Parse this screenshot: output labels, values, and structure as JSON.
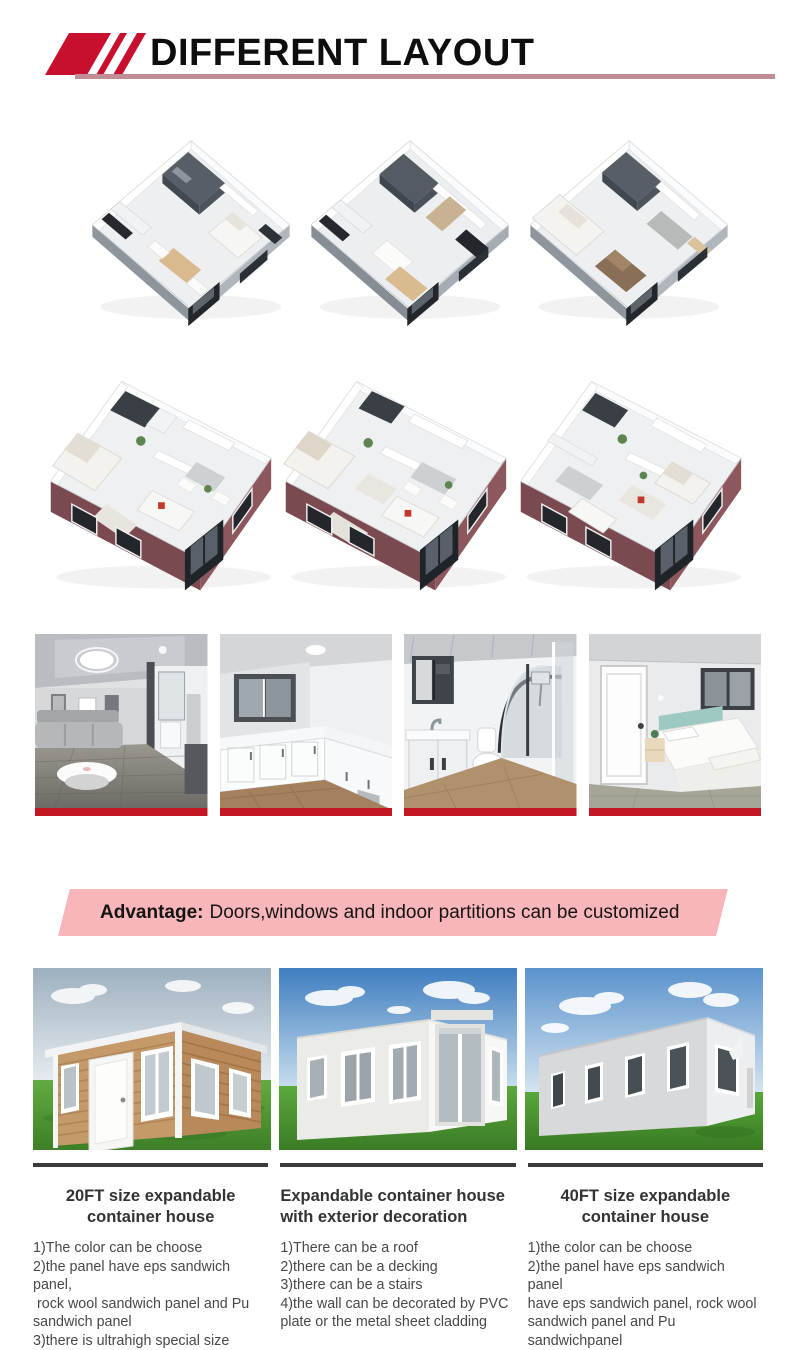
{
  "header": {
    "title": "DIFFERENT LAYOUT"
  },
  "advantage": {
    "label": "Advantage:",
    "text": "Doors,windows and indoor partitions can be customized"
  },
  "colors": {
    "brand_red": "#c8102e",
    "underline_rose": "#c28e95",
    "banner_pink": "#f9b6ba",
    "photo_bar_red": "#c21722",
    "maroon_wall": "#7b4a51"
  },
  "gallery": {
    "floor_plans_row1": [
      "one-bedroom-layout",
      "two-room-layout",
      "two-bedroom-layout"
    ],
    "floor_plans_row2": [
      "large-layout-a",
      "large-layout-b",
      "large-layout-c"
    ],
    "interiors": [
      "living-room-photo",
      "kitchen-photo",
      "bathroom-photo",
      "bedroom-photo"
    ],
    "houses": [
      "wooden-expandable-house",
      "white-expandable-house",
      "long-expandable-house"
    ]
  },
  "products": [
    {
      "title_lines": [
        "20FT size expandable",
        "container house"
      ],
      "features": [
        "1)The color can be choose",
        "2)the panel have eps sandwich panel,",
        " rock wool sandwich panel and Pu",
        "sandwich panel",
        "3)there is ultrahigh special size"
      ]
    },
    {
      "title_lines": [
        "Expandable container house",
        "with exterior decoration"
      ],
      "features": [
        "1)There can be a roof",
        "2)there can be a decking",
        "3)there can be a stairs",
        "4)the wall can be decorated by PVC",
        "plate or the metal sheet cladding"
      ]
    },
    {
      "title_lines": [
        "40FT size expandable",
        "container house"
      ],
      "features": [
        "1)the color can be choose",
        "2)the panel have eps sandwich panel",
        "have eps sandwich panel, rock wool",
        "sandwich panel and Pu sandwichpanel",
        "3)there is ultrahigh special size"
      ]
    }
  ]
}
